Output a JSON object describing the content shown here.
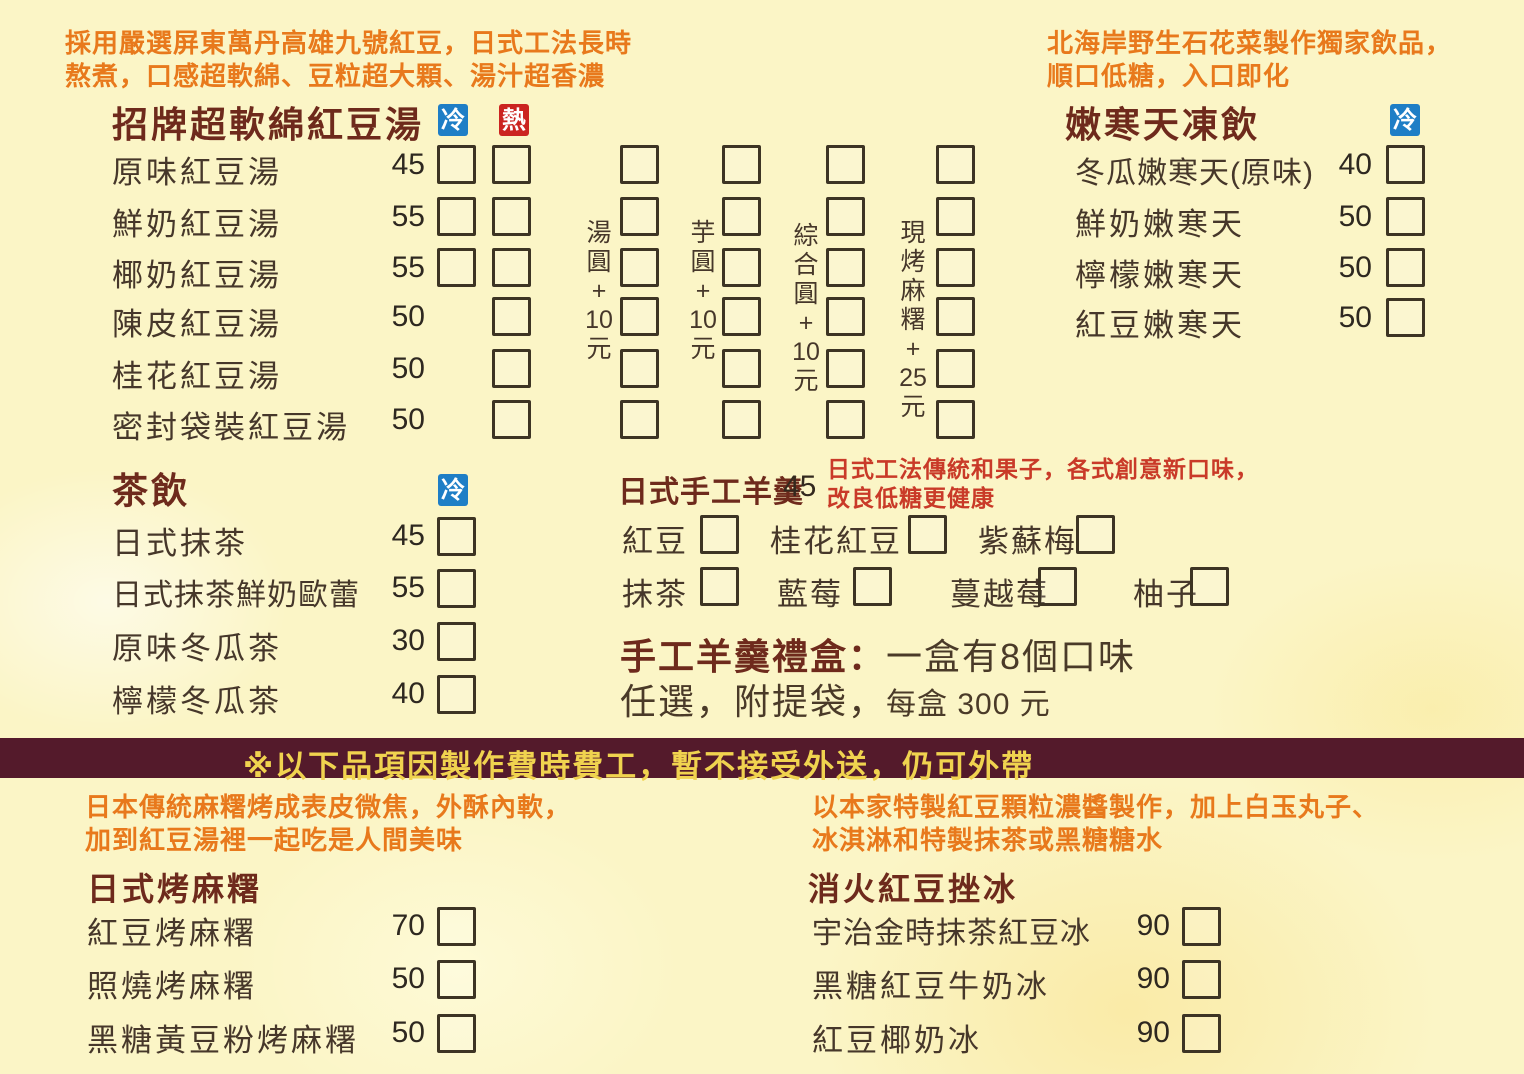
{
  "colors": {
    "background": "#fbf5c6",
    "title": "#6e2a1c",
    "item_text": "#46372a",
    "orange_note": "#e8791c",
    "red_note": "#c93a28",
    "banner_bg": "#541a2b",
    "banner_text": "#f0d34f",
    "badge_cold_bg": "#1e7ec6",
    "badge_hot_bg": "#cb2420"
  },
  "badges": {
    "cold": {
      "label": "冷"
    },
    "hot": {
      "label": "熱"
    }
  },
  "banner": {
    "text": "※以下品項因製作費時費工，暫不接受外送，仍可外帶"
  },
  "sections": {
    "red_bean_soup": {
      "note": [
        "採用嚴選屏東萬丹高雄九號紅豆，日式工法長時",
        "熬煮，口感超軟綿、豆粒超大顆、湯汁超香濃"
      ],
      "title": "招牌超軟綿紅豆湯",
      "items": [
        {
          "name": "原味紅豆湯",
          "price": "45"
        },
        {
          "name": "鮮奶紅豆湯",
          "price": "55"
        },
        {
          "name": "椰奶紅豆湯",
          "price": "55"
        },
        {
          "name": "陳皮紅豆湯",
          "price": "50"
        },
        {
          "name": "桂花紅豆湯",
          "price": "50"
        },
        {
          "name": "密封袋裝紅豆湯",
          "price": "50"
        }
      ],
      "toppings": [
        {
          "name": "湯圓+10元",
          "chars": [
            "湯",
            "圓",
            "+",
            "10",
            "元"
          ]
        },
        {
          "name": "芋圓+10元",
          "chars": [
            "芋",
            "圓",
            "+",
            "10",
            "元"
          ]
        },
        {
          "name": "綜合圓+10元",
          "chars": [
            "綜",
            "合",
            "圓",
            "+",
            "10",
            "元"
          ]
        },
        {
          "name": "現烤麻糬+25元",
          "chars": [
            "現",
            "烤",
            "麻",
            "糬",
            "+",
            "25",
            "元"
          ]
        }
      ]
    },
    "agar_drinks": {
      "note": [
        "北海岸野生石花菜製作獨家飲品，",
        "順口低糖，入口即化"
      ],
      "title": "嫩寒天凍飲",
      "items": [
        {
          "name": "冬瓜嫩寒天(原味)",
          "price": "40"
        },
        {
          "name": "鮮奶嫩寒天",
          "price": "50"
        },
        {
          "name": "檸檬嫩寒天",
          "price": "50"
        },
        {
          "name": "紅豆嫩寒天",
          "price": "50"
        }
      ]
    },
    "tea": {
      "title": "茶飲",
      "items": [
        {
          "name": "日式抹茶",
          "price": "45"
        },
        {
          "name": "日式抹茶鮮奶歐蕾",
          "price": "55"
        },
        {
          "name": "原味冬瓜茶",
          "price": "30"
        },
        {
          "name": "檸檬冬瓜茶",
          "price": "40"
        }
      ]
    },
    "yokan": {
      "title": "日式手工羊羹",
      "price": "45",
      "note": [
        "日式工法傳統和果子，各式創意新口味，",
        "改良低糖更健康"
      ],
      "flavors_row1": [
        {
          "name": "紅豆"
        },
        {
          "name": "桂花紅豆"
        },
        {
          "name": "紫蘇梅"
        }
      ],
      "flavors_row2": [
        {
          "name": "抹茶"
        },
        {
          "name": "藍莓"
        },
        {
          "name": "蔓越莓"
        },
        {
          "name": "柚子"
        }
      ],
      "gift_box": {
        "title": "手工羊羹禮盒",
        "colon": "：",
        "line1": "一盒有8個口味",
        "line2": "任選，附提袋，",
        "line2_small": "每盒 300 元"
      }
    },
    "grilled_mochi": {
      "note": [
        "日本傳統麻糬烤成表皮微焦，外酥內軟，",
        "加到紅豆湯裡一起吃是人間美味"
      ],
      "title": "日式烤麻糬",
      "items": [
        {
          "name": "紅豆烤麻糬",
          "price": "70"
        },
        {
          "name": "照燒烤麻糬",
          "price": "50"
        },
        {
          "name": "黑糖黃豆粉烤麻糬",
          "price": "50"
        }
      ]
    },
    "shaved_ice": {
      "note": [
        "以本家特製紅豆顆粒濃醬製作，加上白玉丸子、",
        "冰淇淋和特製抹茶或黑糖糖水"
      ],
      "title": "消火紅豆挫冰",
      "items": [
        {
          "name": "宇治金時抹茶紅豆冰",
          "price": "90"
        },
        {
          "name": "黑糖紅豆牛奶冰",
          "price": "90"
        },
        {
          "name": "紅豆椰奶冰",
          "price": "90"
        }
      ]
    }
  }
}
